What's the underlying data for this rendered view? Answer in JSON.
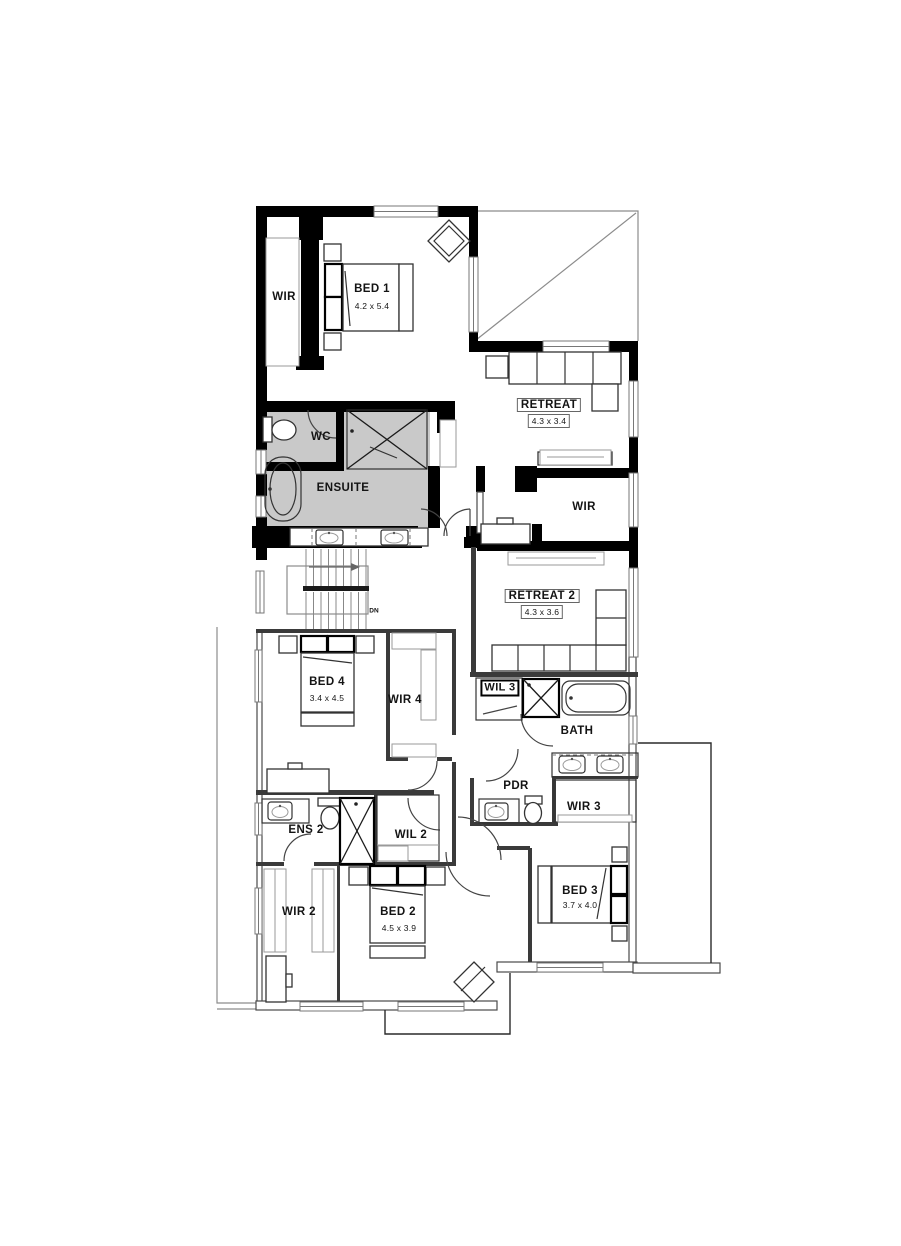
{
  "colors": {
    "wall": "#000000",
    "shade": "#c9c9c9",
    "innerwall": "#3a3a3a",
    "outline": "#8c8c8c",
    "text": "#141414"
  },
  "rooms": {
    "wir_a": {
      "label": "WIR"
    },
    "bed1": {
      "label": "BED 1",
      "dims": "4.2 x 5.4"
    },
    "retreat": {
      "label": "RETREAT",
      "dims": "4.3 x 3.4"
    },
    "wc": {
      "label": "WC"
    },
    "ensuite": {
      "label": "ENSUITE"
    },
    "wir_b": {
      "label": "WIR"
    },
    "retreat2": {
      "label": "RETREAT 2",
      "dims": "4.3 x 3.6"
    },
    "bed4": {
      "label": "BED 4",
      "dims": "3.4 x 4.5"
    },
    "wir4": {
      "label": "WIR 4"
    },
    "wil3": {
      "label": "WIL 3"
    },
    "bath": {
      "label": "BATH"
    },
    "pdr": {
      "label": "PDR"
    },
    "wir3": {
      "label": "WIR 3"
    },
    "ens2": {
      "label": "ENS 2"
    },
    "wil2": {
      "label": "WIL 2"
    },
    "wir2": {
      "label": "WIR 2"
    },
    "bed2": {
      "label": "BED 2",
      "dims": "4.5 x 3.9"
    },
    "bed3": {
      "label": "BED 3",
      "dims": "3.7 x 4.0"
    }
  },
  "stairs": {
    "dn": "DN"
  }
}
